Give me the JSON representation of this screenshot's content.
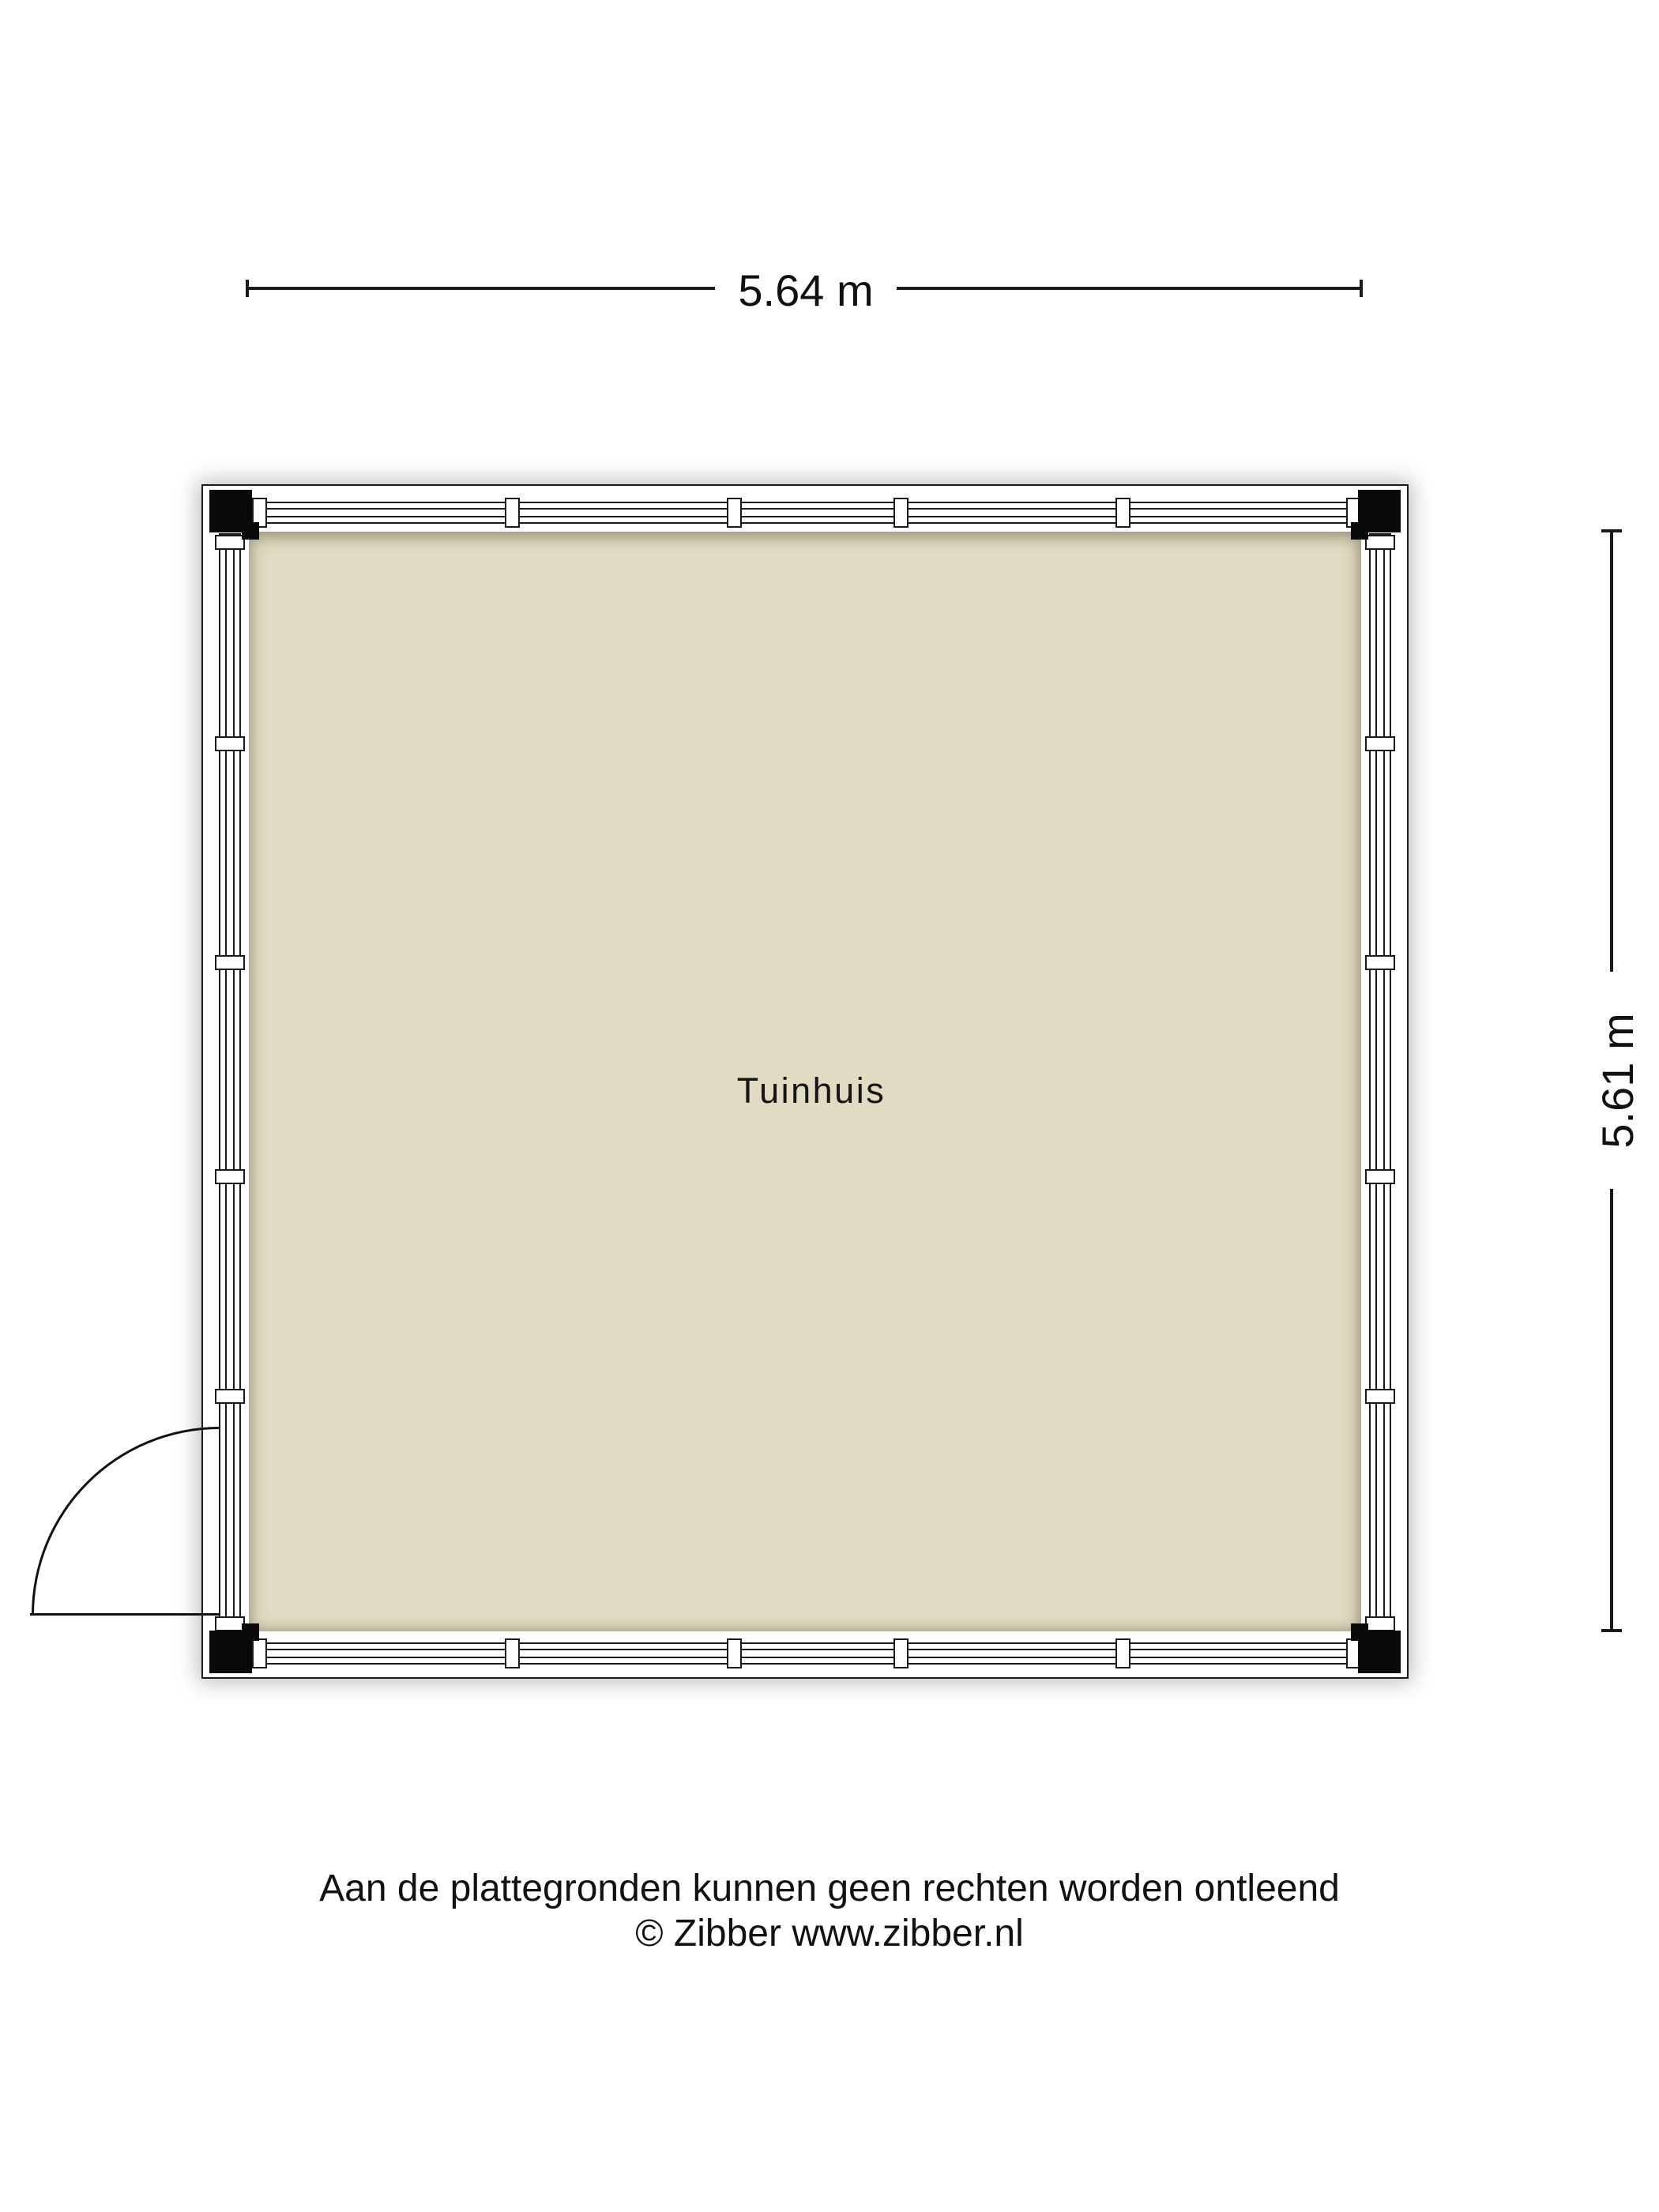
{
  "plan": {
    "room_label": "Tuinhuis",
    "dimensions": {
      "width_label": "5.64 m",
      "height_label": "5.61 m"
    },
    "colors": {
      "floor": "#e1dbc3",
      "wall_band": "#ffffff",
      "outline": "#1a1a1a",
      "corner_post": "#0a0a0a"
    }
  },
  "footer": {
    "line1": "Aan de plattegronden kunnen geen rechten worden ontleend",
    "line2": "© Zibber www.zibber.nl"
  }
}
